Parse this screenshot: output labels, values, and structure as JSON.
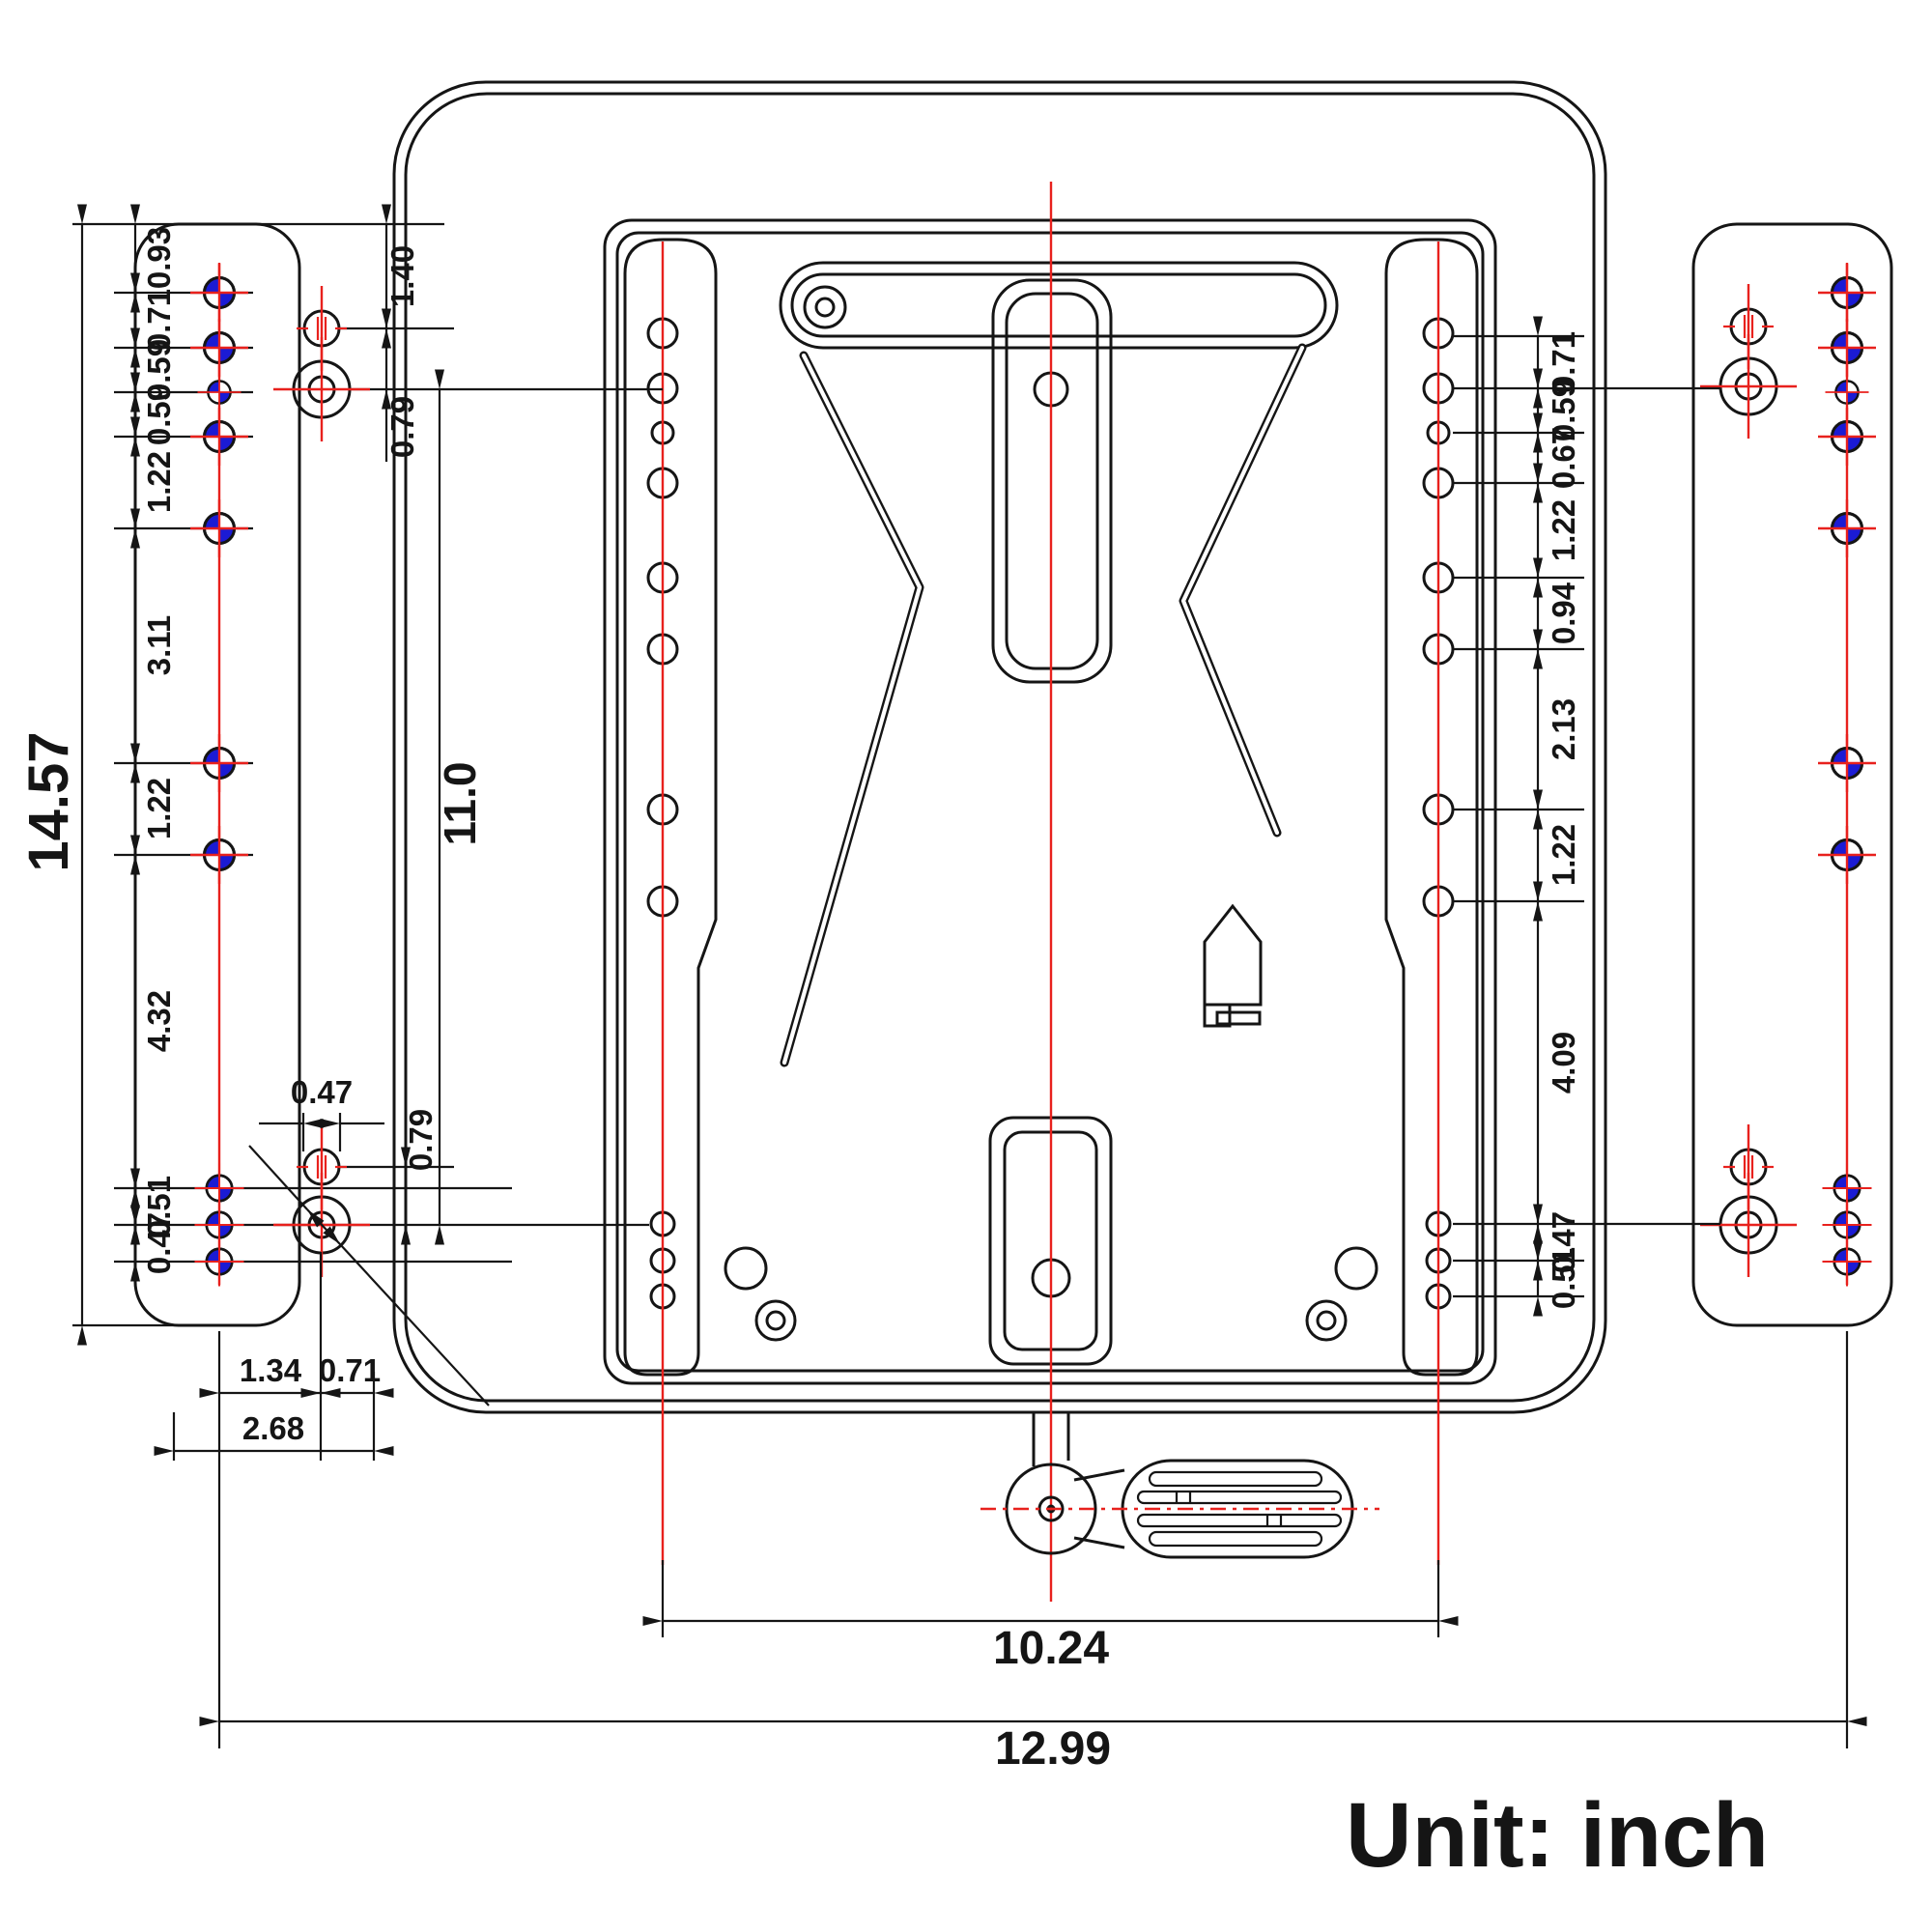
{
  "drawing": {
    "title": "seat-swivel-base-mounting-dimensions",
    "unit_note": "Unit: inch",
    "colors": {
      "ink": "#151515",
      "centerline_red": "#e8211d",
      "datum_blue": "#1b1bd4"
    },
    "dims": {
      "left_chain": [
        "0.93",
        "0.71",
        "0.59",
        "0.59",
        "1.22",
        "3.11",
        "1.22",
        "4.32",
        "0.51",
        "0.47"
      ],
      "left_overall": "14.57",
      "inner_height": "11.0",
      "upper_left": {
        "edge_to_hole": "1.40",
        "hole_gap": "0.79"
      },
      "lower_left": {
        "slot_width": "0.47",
        "hole_gap": "0.79",
        "offset_a": "1.34",
        "offset_b": "0.71",
        "offset_total": "2.68"
      },
      "right_chain": [
        "0.71",
        "0.59",
        "0.67",
        "1.22",
        "0.94",
        "2.13",
        "1.22",
        "4.09",
        "0.47",
        "0.51"
      ],
      "inner_width": "10.24",
      "outer_width": "12.99"
    }
  }
}
